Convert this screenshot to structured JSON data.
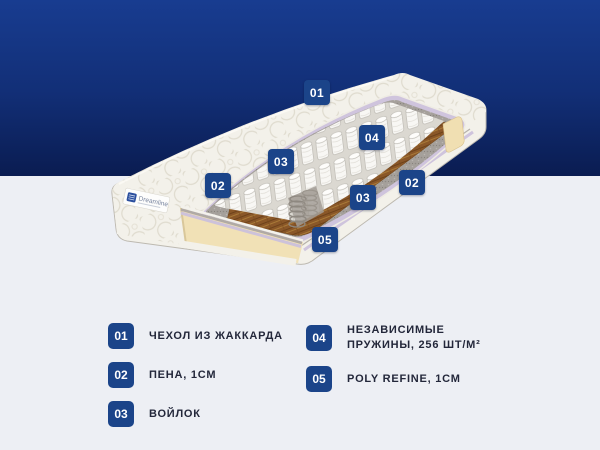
{
  "brand": {
    "name": "Dreamline"
  },
  "colors": {
    "badge": "#1b4489",
    "hero_top": "#183c90",
    "hero_bottom": "#0a1c51",
    "page_bg": "#edeff4",
    "legend_text": "#23273a"
  },
  "diagram": {
    "markers": [
      {
        "label": "01"
      },
      {
        "label": "02"
      },
      {
        "label": "03"
      },
      {
        "label": "04"
      },
      {
        "label": "02"
      },
      {
        "label": "03"
      },
      {
        "label": "05"
      }
    ]
  },
  "legend": {
    "items": [
      {
        "num": "01",
        "label": "ЧЕХОЛ ИЗ ЖАККАРДА"
      },
      {
        "num": "02",
        "label": "ПЕНА, 1СМ"
      },
      {
        "num": "03",
        "label": "ВОЙЛОК"
      },
      {
        "num": "04",
        "label": "НЕЗАВИСИМЫЕ ПРУЖИНЫ, 256 ШТ/М²"
      },
      {
        "num": "05",
        "label": "POLY REFINE, 1СМ"
      }
    ]
  }
}
